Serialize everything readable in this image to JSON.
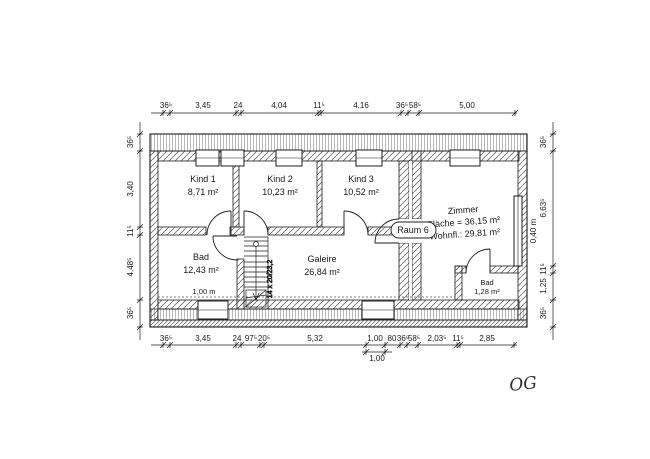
{
  "meta": {
    "drawing_label": "OG"
  },
  "rooms": {
    "kind1": {
      "name": "Kind 1",
      "area": "8,71 m²"
    },
    "kind2": {
      "name": "Kind 2",
      "area": "10,23 m²"
    },
    "kind3": {
      "name": "Kind 3",
      "area": "10,52 m²"
    },
    "bad": {
      "name": "Bad",
      "area": "12,43 m²"
    },
    "galerie": {
      "name": "Galeire",
      "area": "26,84 m²"
    },
    "zimmer": {
      "name": "Zimmer",
      "line2": "Fläche = 36,15 m²",
      "line3": "Wohnfl.: 29,81 m²"
    },
    "raum6": {
      "name": "Raum 6"
    },
    "bad_klein": {
      "name": "Bad",
      "area": "1,28 m²"
    }
  },
  "annotations": {
    "height_line": "1,00 m",
    "stair": "14 x 20/23,2",
    "window_width": "0,40 m"
  },
  "dimensions": {
    "top": {
      "labels": [
        "36⁵",
        "3,45",
        "24",
        "4,04",
        "11⁵",
        "4,16",
        "36⁵",
        "58⁵",
        "5,00"
      ]
    },
    "bottom": {
      "labels": [
        "36⁵",
        "3,45",
        "24",
        "97⁵",
        "20⁵",
        "5,32",
        "1,00",
        "80",
        "36⁵",
        "58⁵",
        "2,03⁵",
        "11⁵",
        "2,85"
      ]
    },
    "bottom2": {
      "labels": [
        "1,00"
      ]
    },
    "left": {
      "labels": [
        "36⁵",
        "3,40",
        "11⁵",
        "4,48⁵",
        "36⁵"
      ]
    },
    "right": {
      "labels": [
        "36⁵",
        "6,63⁵",
        "11⁵",
        "1,25",
        "36⁵"
      ]
    }
  },
  "colors": {
    "line": "#1c1c1c",
    "hatch": "#6b6b6b",
    "stripe": "#8a8a8a"
  }
}
